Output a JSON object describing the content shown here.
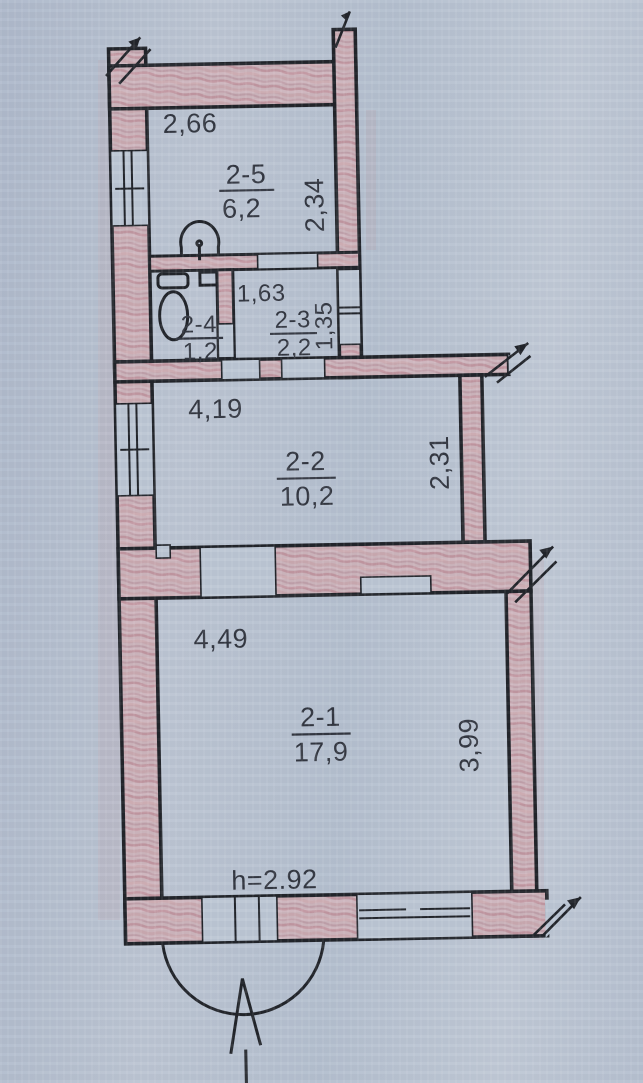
{
  "plan": {
    "rooms": [
      {
        "id": "2-1",
        "area": "17,9",
        "dim_w": "4,49",
        "dim_h": "3,99"
      },
      {
        "id": "2-2",
        "area": "10,2",
        "dim_w": "4,19",
        "dim_h": "2,31"
      },
      {
        "id": "2-3",
        "area": "2,2",
        "dim_w": "1,63",
        "dim_h": "1,35"
      },
      {
        "id": "2-4",
        "area": "1,2"
      },
      {
        "id": "2-5",
        "area": "6,2",
        "dim_w": "2,66",
        "dim_h": "2,34"
      }
    ],
    "ceiling_height": "h=2.92"
  },
  "icons": {
    "toilet": "toilet-icon",
    "sink": "sink-icon",
    "entrance_arrow": "entrance-arrow",
    "entry_swing": "entry-swing-arc"
  },
  "colors": {
    "paper": "#bcc6d4",
    "paper_light": "#ccd3de",
    "wall_fill": "#c9aeb6",
    "wall_hatch": "#b9848f",
    "ink": "#22252b",
    "ink_text": "#333741"
  }
}
